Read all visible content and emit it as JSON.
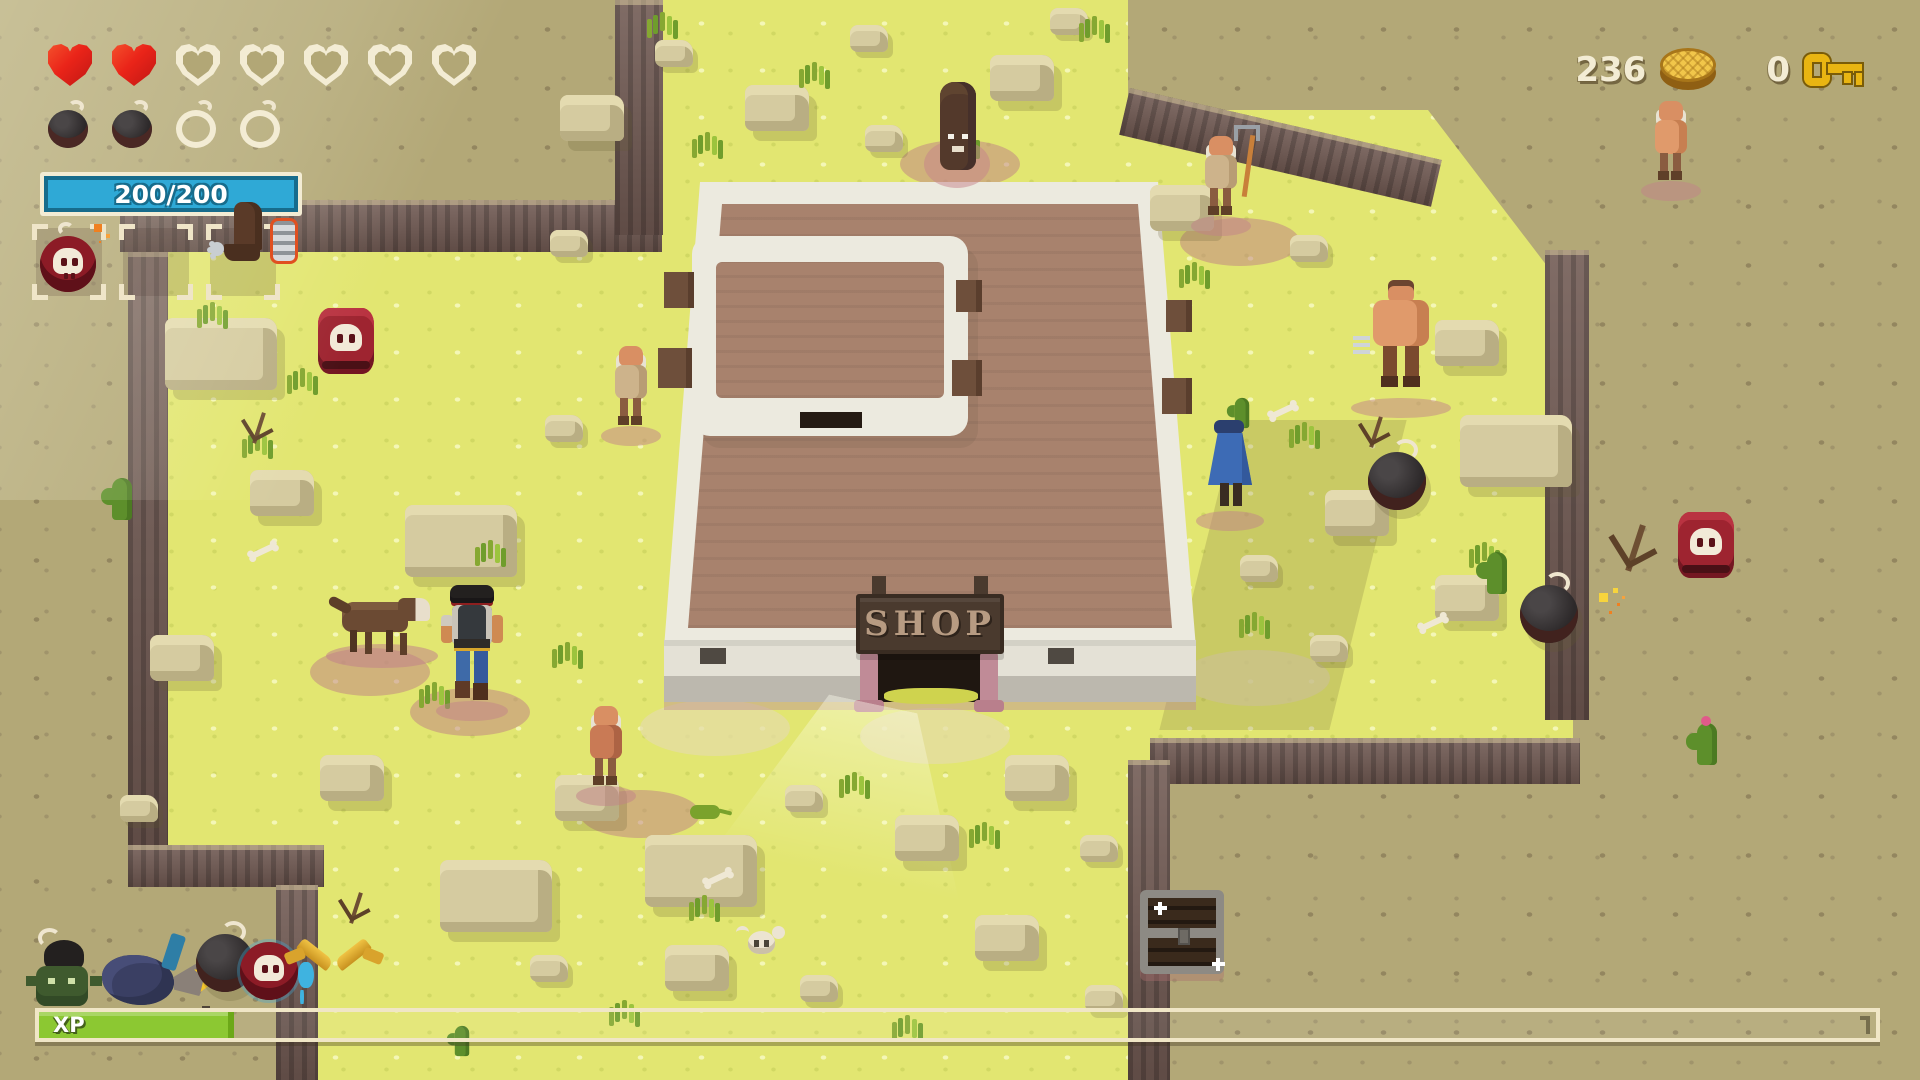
{
  "hud": {
    "hearts": {
      "filled": 2,
      "total": 7
    },
    "bombs": {
      "filled": 2,
      "total": 4
    },
    "health_bar": {
      "label": "200/200",
      "current": 200,
      "max": 200,
      "fill_color": "#2fa9d6"
    },
    "item_slots": [
      {
        "item": "skull-bomb",
        "name": "slot-skull-bomb"
      },
      {
        "item": "",
        "name": "slot-empty"
      },
      {
        "item": "boot-spur",
        "name": "slot-boot-spur"
      }
    ],
    "currency": {
      "coins": "236",
      "keys": "0"
    },
    "xp": {
      "label": "XP",
      "percent": 10.6,
      "fill_color": "#8cc832"
    }
  },
  "shop": {
    "sign": "SHOP"
  },
  "icons": {
    "coin-icon": "gold-coin",
    "key-icon": "gold-key",
    "heart-icon": "pixel-heart",
    "bomb-icon": "round-bomb",
    "skull-icon": "skull"
  },
  "colors": {
    "heart_red": "#ea2419",
    "hud_cream": "#f3ecd4",
    "grass": "#e2e671",
    "plateau": "#b3a877"
  },
  "scene": {
    "sprites": [
      {
        "t": "dirt",
        "x": 900,
        "y": 140
      },
      {
        "t": "dirt",
        "x": 310,
        "y": 648
      },
      {
        "t": "dirt",
        "x": 410,
        "y": 688
      },
      {
        "t": "dirt",
        "x": 1180,
        "y": 218
      },
      {
        "t": "dirt",
        "x": 580,
        "y": 790
      },
      {
        "t": "sand",
        "x": 640,
        "y": 700
      },
      {
        "t": "sand",
        "x": 860,
        "y": 708
      },
      {
        "t": "sand",
        "x": 1180,
        "y": 650
      },
      {
        "t": "light-cone",
        "x": 730,
        "y": 702
      },
      {
        "t": "shadow-wedge",
        "x": 1198,
        "y": 420
      },
      {
        "t": "rock-lg",
        "x": 165,
        "y": 318
      },
      {
        "t": "rock",
        "x": 250,
        "y": 470
      },
      {
        "t": "rock-lg",
        "x": 405,
        "y": 505
      },
      {
        "t": "rock-sm",
        "x": 545,
        "y": 415
      },
      {
        "t": "rock",
        "x": 150,
        "y": 635
      },
      {
        "t": "rock",
        "x": 320,
        "y": 755
      },
      {
        "t": "rock-sm",
        "x": 120,
        "y": 795
      },
      {
        "t": "rock-lg",
        "x": 440,
        "y": 860
      },
      {
        "t": "rock-sm",
        "x": 530,
        "y": 955
      },
      {
        "t": "rock",
        "x": 560,
        "y": 95
      },
      {
        "t": "rock-sm",
        "x": 655,
        "y": 40
      },
      {
        "t": "rock",
        "x": 745,
        "y": 85
      },
      {
        "t": "rock-sm",
        "x": 850,
        "y": 25
      },
      {
        "t": "rock",
        "x": 990,
        "y": 55
      },
      {
        "t": "rock-sm",
        "x": 1050,
        "y": 8
      },
      {
        "t": "rock-sm",
        "x": 865,
        "y": 125
      },
      {
        "t": "rock",
        "x": 1150,
        "y": 185
      },
      {
        "t": "rock-sm",
        "x": 1290,
        "y": 235
      },
      {
        "t": "rock",
        "x": 1435,
        "y": 320
      },
      {
        "t": "rock-lg",
        "x": 1460,
        "y": 415
      },
      {
        "t": "rock",
        "x": 1325,
        "y": 490
      },
      {
        "t": "rock-sm",
        "x": 1240,
        "y": 555
      },
      {
        "t": "rock",
        "x": 1435,
        "y": 575
      },
      {
        "t": "rock-sm",
        "x": 1310,
        "y": 635
      },
      {
        "t": "rock",
        "x": 555,
        "y": 775
      },
      {
        "t": "rock-lg",
        "x": 645,
        "y": 835
      },
      {
        "t": "rock-sm",
        "x": 785,
        "y": 785
      },
      {
        "t": "rock",
        "x": 895,
        "y": 815
      },
      {
        "t": "rock",
        "x": 1005,
        "y": 755
      },
      {
        "t": "rock-sm",
        "x": 1080,
        "y": 835
      },
      {
        "t": "rock",
        "x": 665,
        "y": 945
      },
      {
        "t": "rock-sm",
        "x": 800,
        "y": 975
      },
      {
        "t": "rock",
        "x": 975,
        "y": 915
      },
      {
        "t": "rock-sm",
        "x": 1085,
        "y": 985
      },
      {
        "t": "rock-sm",
        "x": 550,
        "y": 230
      },
      {
        "t": "grass-tuft",
        "x": 210,
        "y": 302
      },
      {
        "t": "grass-tuft",
        "x": 300,
        "y": 368
      },
      {
        "t": "grass-tuft",
        "x": 255,
        "y": 432
      },
      {
        "t": "grass-tuft",
        "x": 488,
        "y": 540
      },
      {
        "t": "grass-tuft",
        "x": 565,
        "y": 642
      },
      {
        "t": "grass-tuft",
        "x": 432,
        "y": 682
      },
      {
        "t": "grass-tuft",
        "x": 705,
        "y": 132
      },
      {
        "t": "grass-tuft",
        "x": 812,
        "y": 62
      },
      {
        "t": "grass-tuft",
        "x": 962,
        "y": 132
      },
      {
        "t": "grass-tuft",
        "x": 1192,
        "y": 262
      },
      {
        "t": "grass-tuft",
        "x": 1302,
        "y": 422
      },
      {
        "t": "grass-tuft",
        "x": 1482,
        "y": 542
      },
      {
        "t": "grass-tuft",
        "x": 1252,
        "y": 612
      },
      {
        "t": "grass-tuft",
        "x": 702,
        "y": 895
      },
      {
        "t": "grass-tuft",
        "x": 852,
        "y": 772
      },
      {
        "t": "grass-tuft",
        "x": 982,
        "y": 822
      },
      {
        "t": "grass-tuft",
        "x": 622,
        "y": 1000
      },
      {
        "t": "grass-tuft",
        "x": 905,
        "y": 1015
      },
      {
        "t": "grass-tuft",
        "x": 660,
        "y": 12
      },
      {
        "t": "grass-tuft",
        "x": 1092,
        "y": 16
      },
      {
        "t": "cactus",
        "x": 112,
        "y": 478
      },
      {
        "t": "cactus-sm",
        "x": 1232,
        "y": 392
      },
      {
        "t": "cactus",
        "x": 1487,
        "y": 552
      },
      {
        "t": "cactus-flower",
        "x": 1697,
        "y": 723
      },
      {
        "t": "cactus-sm",
        "x": 452,
        "y": 1020
      },
      {
        "t": "deadbush",
        "x": 235,
        "y": 408
      },
      {
        "t": "deadbush",
        "x": 332,
        "y": 888
      },
      {
        "t": "deadbush-lg",
        "x": 1612,
        "y": 528
      },
      {
        "t": "deadbush",
        "x": 1352,
        "y": 412
      },
      {
        "t": "bone",
        "x": 250,
        "y": 548
      },
      {
        "t": "bone",
        "x": 1270,
        "y": 408
      },
      {
        "t": "bone",
        "x": 705,
        "y": 875
      },
      {
        "t": "bone",
        "x": 1420,
        "y": 620
      },
      {
        "t": "barrel-skull",
        "x": 318,
        "y": 308,
        "n": "skull-barrel",
        "i": true
      },
      {
        "t": "barrel-skull",
        "x": 1678,
        "y": 512,
        "n": "skull-barrel",
        "i": true
      },
      {
        "t": "bomb-sprite",
        "x": 1368,
        "y": 452,
        "n": "world-bomb",
        "i": true
      },
      {
        "t": "bomb-spark",
        "x": 1520,
        "y": 585,
        "n": "world-bomb-lit",
        "i": true
      },
      {
        "t": "wolf-front",
        "x": 930,
        "y": 82,
        "n": "wolf-front",
        "i": true
      },
      {
        "t": "wolf-side",
        "x": 330,
        "y": 588,
        "n": "wolf-side",
        "i": true
      },
      {
        "t": "farmer-pitchfork",
        "x": 1195,
        "y": 130,
        "n": "farmer-with-pitchfork",
        "i": true
      },
      {
        "t": "npc-oldman",
        "x": 605,
        "y": 340,
        "n": "villager-oldman",
        "i": true
      },
      {
        "t": "npc-oldman-red",
        "x": 580,
        "y": 700,
        "n": "villager-oldman",
        "i": true
      },
      {
        "t": "npc-shirtless",
        "x": 1645,
        "y": 95,
        "n": "villager-shirtless",
        "i": true
      },
      {
        "t": "player-cowboy",
        "x": 440,
        "y": 585,
        "n": "player-character",
        "i": true
      },
      {
        "t": "brute-claws",
        "x": 1355,
        "y": 280,
        "n": "brute-with-claws",
        "i": true
      },
      {
        "t": "blue-cape",
        "x": 1200,
        "y": 420,
        "n": "caped-villager",
        "i": true
      },
      {
        "t": "chest",
        "x": 1140,
        "y": 890,
        "n": "treasure-chest",
        "i": true
      },
      {
        "t": "skull-ground",
        "x": 738,
        "y": 922,
        "n": "ground-skull",
        "i": false
      },
      {
        "t": "lizard",
        "x": 690,
        "y": 805,
        "n": "lizard",
        "i": false
      },
      {
        "t": "goblin-hat",
        "x": 28,
        "y": 942,
        "n": "loot-goblin-bombhat",
        "i": true
      },
      {
        "t": "cloth-navy",
        "x": 102,
        "y": 955,
        "n": "loot-cloth",
        "i": true
      },
      {
        "t": "pickaxe-star",
        "x": 158,
        "y": 932,
        "n": "loot-pickaxe",
        "i": true
      },
      {
        "t": "bomb-sprite",
        "x": 196,
        "y": 934,
        "n": "loot-bomb",
        "i": true
      },
      {
        "t": "skull-orb",
        "x": 240,
        "y": 940,
        "n": "loot-skull-orb",
        "i": true
      },
      {
        "t": "gold-pistols",
        "x": 292,
        "y": 938,
        "n": "loot-golden-pistols",
        "i": true
      }
    ]
  }
}
